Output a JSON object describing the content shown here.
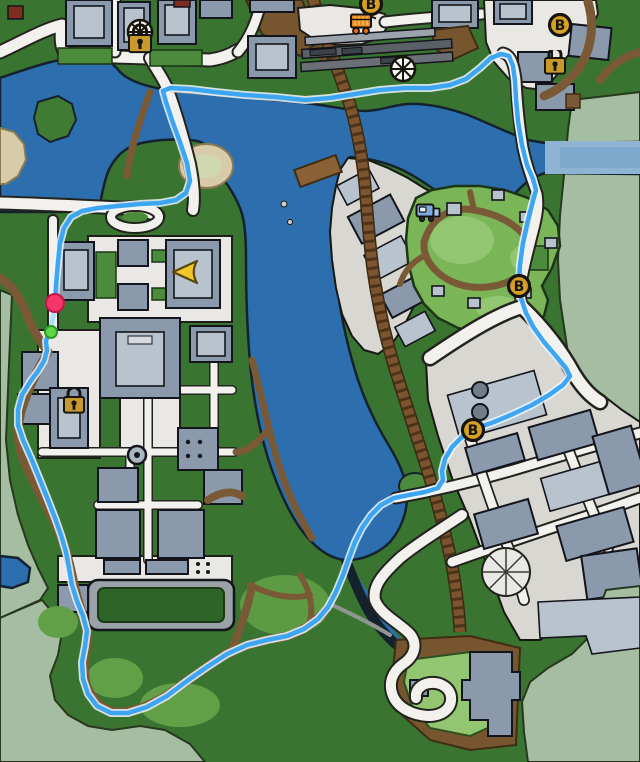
{
  "map": {
    "palette": {
      "land": "#3a7431",
      "land_dark": "#2f6428",
      "fog": "#a5bda0",
      "water": "#2d6fae",
      "water_light": "#8fb3d3",
      "park": "#7ab558",
      "park_light": "#93c671",
      "grass_mid": "#4c8a3c",
      "road_fill": "#f2f1ed",
      "plaza": "#e9e8e4",
      "ground": "#d8d7d2",
      "building": "#8a9aac",
      "building_light": "#b9c3ce",
      "dirt": "#7a5a36",
      "rail": "#7c5530",
      "route": "#3da6f2",
      "marker_gold": "#d7a023",
      "start_pink": "#f5356b",
      "waypoint_green": "#5fd648"
    },
    "markers": [
      {
        "type": "locked-venue",
        "x": 140,
        "y": 38
      },
      {
        "type": "store-b",
        "label": "B",
        "x": 371,
        "y": 4
      },
      {
        "type": "food-cart",
        "x": 363,
        "y": 23
      },
      {
        "type": "ferris-wheel",
        "x": 403,
        "y": 69
      },
      {
        "type": "store-b",
        "label": "B",
        "x": 560,
        "y": 25
      },
      {
        "type": "lock",
        "x": 555,
        "y": 64
      },
      {
        "type": "truck",
        "x": 428,
        "y": 212
      },
      {
        "type": "player-arrow",
        "x": 185,
        "y": 272
      },
      {
        "type": "store-b",
        "label": "B",
        "x": 519,
        "y": 286
      },
      {
        "type": "lock",
        "x": 74,
        "y": 403
      },
      {
        "type": "store-b",
        "label": "B",
        "x": 473,
        "y": 430
      },
      {
        "type": "route-start",
        "x": 55,
        "y": 303
      },
      {
        "type": "waypoint-dot",
        "x": 51,
        "y": 332
      }
    ],
    "route": {
      "color": "#3da6f2",
      "points": [
        [
          55,
          303
        ],
        [
          56,
          285
        ],
        [
          58,
          262
        ],
        [
          60,
          243
        ],
        [
          64,
          228
        ],
        [
          71,
          217
        ],
        [
          82,
          211
        ],
        [
          98,
          208
        ],
        [
          118,
          206
        ],
        [
          140,
          204
        ],
        [
          160,
          203
        ],
        [
          176,
          200
        ],
        [
          186,
          193
        ],
        [
          190,
          181
        ],
        [
          187,
          163
        ],
        [
          180,
          142
        ],
        [
          172,
          120
        ],
        [
          166,
          102
        ],
        [
          163,
          91
        ],
        [
          170,
          88
        ],
        [
          190,
          89
        ],
        [
          215,
          92
        ],
        [
          245,
          95
        ],
        [
          275,
          97
        ],
        [
          305,
          100
        ],
        [
          330,
          98
        ],
        [
          355,
          94
        ],
        [
          380,
          90
        ],
        [
          405,
          88
        ],
        [
          430,
          88
        ],
        [
          450,
          85
        ],
        [
          466,
          79
        ],
        [
          480,
          68
        ],
        [
          491,
          58
        ],
        [
          501,
          54
        ],
        [
          509,
          56
        ],
        [
          513,
          66
        ],
        [
          515,
          81
        ],
        [
          516,
          99
        ],
        [
          518,
          121
        ],
        [
          522,
          145
        ],
        [
          527,
          165
        ],
        [
          533,
          179
        ],
        [
          536,
          190
        ],
        [
          533,
          201
        ],
        [
          528,
          220
        ],
        [
          523,
          243
        ],
        [
          520,
          265
        ],
        [
          519,
          283
        ],
        [
          521,
          298
        ],
        [
          526,
          313
        ],
        [
          534,
          328
        ],
        [
          544,
          342
        ],
        [
          556,
          356
        ],
        [
          566,
          368
        ],
        [
          570,
          376
        ],
        [
          563,
          385
        ],
        [
          549,
          395
        ],
        [
          532,
          405
        ],
        [
          513,
          414
        ],
        [
          494,
          422
        ],
        [
          477,
          428
        ],
        [
          463,
          436
        ],
        [
          452,
          447
        ],
        [
          445,
          459
        ],
        [
          442,
          471
        ],
        [
          443,
          480
        ],
        [
          438,
          488
        ],
        [
          425,
          492
        ],
        [
          409,
          495
        ],
        [
          394,
          498
        ],
        [
          381,
          505
        ],
        [
          371,
          515
        ],
        [
          362,
          528
        ],
        [
          355,
          542
        ],
        [
          349,
          558
        ],
        [
          343,
          575
        ],
        [
          336,
          592
        ],
        [
          328,
          607
        ],
        [
          318,
          619
        ],
        [
          304,
          629
        ],
        [
          287,
          636
        ],
        [
          267,
          640
        ],
        [
          247,
          645
        ],
        [
          227,
          654
        ],
        [
          207,
          667
        ],
        [
          187,
          681
        ],
        [
          167,
          696
        ],
        [
          147,
          707
        ],
        [
          128,
          713
        ],
        [
          111,
          713
        ],
        [
          97,
          706
        ],
        [
          88,
          694
        ],
        [
          83,
          679
        ],
        [
          82,
          662
        ],
        [
          85,
          646
        ],
        [
          87,
          631
        ],
        [
          83,
          616
        ],
        [
          77,
          601
        ],
        [
          72,
          585
        ],
        [
          69,
          568
        ],
        [
          66,
          552
        ],
        [
          61,
          535
        ],
        [
          55,
          518
        ],
        [
          48,
          500
        ],
        [
          40,
          480
        ],
        [
          31,
          458
        ],
        [
          23,
          440
        ],
        [
          18,
          425
        ],
        [
          18,
          410
        ],
        [
          22,
          395
        ],
        [
          30,
          382
        ],
        [
          38,
          371
        ],
        [
          44,
          361
        ],
        [
          47,
          351
        ],
        [
          46,
          341
        ],
        [
          48,
          335
        ],
        [
          51,
          331
        ]
      ],
      "start_leg": [
        [
          55,
          305
        ],
        [
          53,
          317
        ],
        [
          51,
          329
        ]
      ]
    }
  }
}
